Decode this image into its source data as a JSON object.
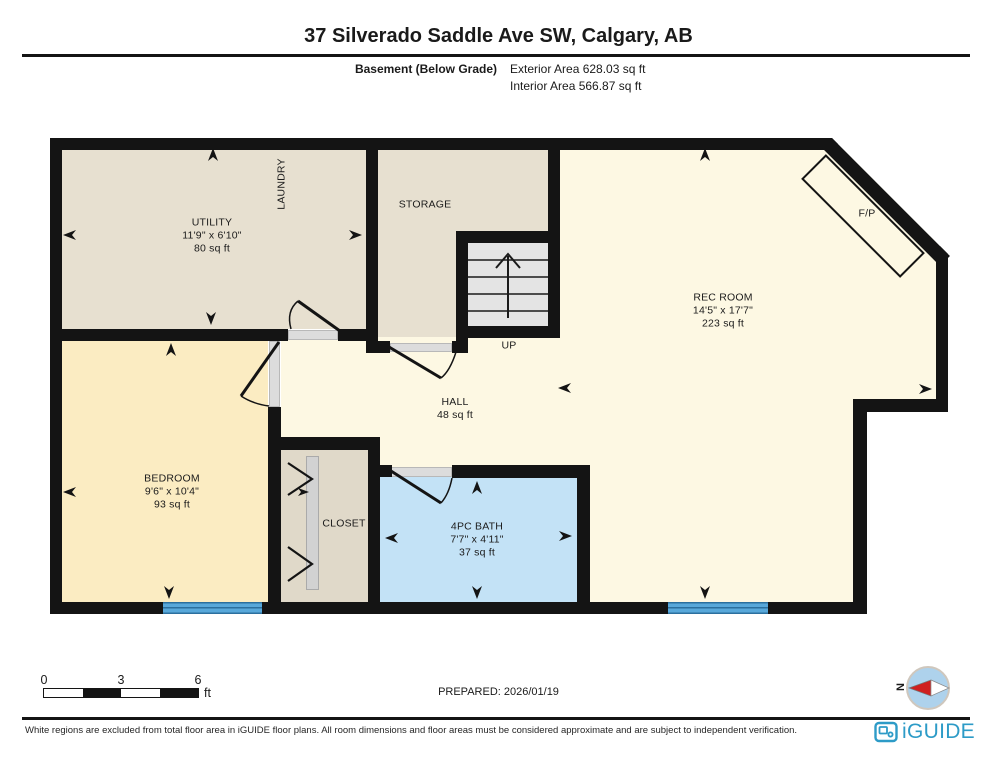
{
  "header": {
    "title": "37 Silverado Saddle Ave SW, Calgary, AB",
    "floor_label": "Basement (Below Grade)",
    "exterior_area": "Exterior Area 628.03 sq ft",
    "interior_area": "Interior Area 566.87 sq ft"
  },
  "rooms": {
    "utility": {
      "name": "UTILITY",
      "dims": "11'9\" x 6'10\"",
      "area": "80 sq ft"
    },
    "laundry": {
      "name": "LAUNDRY"
    },
    "storage": {
      "name": "STORAGE"
    },
    "stairs": {
      "direction_label": "UP"
    },
    "rec_room": {
      "name": "REC ROOM",
      "dims": "14'5\" x 17'7\"",
      "area": "223 sq ft"
    },
    "hall": {
      "name": "HALL",
      "area": "48 sq ft"
    },
    "bedroom": {
      "name": "BEDROOM",
      "dims": "9'6\" x 10'4\"",
      "area": "93 sq ft"
    },
    "closet": {
      "name": "CLOSET"
    },
    "bath": {
      "name": "4PC BATH",
      "dims": "7'7\" x 4'11\"",
      "area": "37 sq ft"
    },
    "fireplace": {
      "name": "F/P"
    }
  },
  "scale_bar": {
    "ticks": [
      "0",
      "3",
      "6"
    ],
    "unit": "ft"
  },
  "compass": {
    "north_label": "N"
  },
  "footer": {
    "prepared": "PREPARED: 2026/01/19",
    "disclaimer": "White regions are excluded from total floor area in iGUIDE floor plans. All room dimensions and floor areas must be considered approximate and are subject to independent verification.",
    "brand": "iGUIDE"
  },
  "colors": {
    "wall": "#141414",
    "room_beige": "#e7e0d0",
    "room_cream": "#fdf8e3",
    "room_yellow": "#fbecc2",
    "room_blue": "#c3e2f6",
    "closet_tan": "#e0d9c9",
    "stairs_gray": "#e4e4e4",
    "window_blue": "#58a8da",
    "brand_blue": "#2d9bc7",
    "compass_fill": "#aed2ec",
    "compass_red": "#cf2020"
  }
}
